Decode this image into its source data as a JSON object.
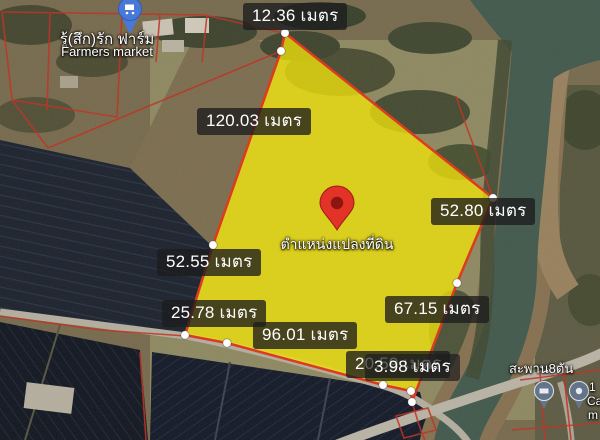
{
  "map": {
    "type": "satellite-parcel-view",
    "unit": "เมตร",
    "parcel": {
      "marker_label_thai": "ตำแหน่งแปลงที่ดิน",
      "marker_color": "#e33227",
      "fill_color": "#ecdf0e",
      "border_color": "#dd3b20",
      "measurements": [
        {
          "side": "top",
          "text": "12.36 เมตร",
          "value_m": 12.36
        },
        {
          "side": "upper-left",
          "text": "120.03 เมตร",
          "value_m": 120.03
        },
        {
          "side": "right",
          "text": "52.80 เมตร",
          "value_m": 52.8
        },
        {
          "side": "left",
          "text": "52.55 เมตร",
          "value_m": 52.55
        },
        {
          "side": "lower-left",
          "text": "25.78 เมตร",
          "value_m": 25.78
        },
        {
          "side": "bottom",
          "text": "96.01 เมตร",
          "value_m": 96.01
        },
        {
          "side": "lower-right",
          "text": "67.15 เมตร",
          "value_m": 67.15
        },
        {
          "side": "bottom-corner-a",
          "text": "20.59 เมตร",
          "value_m": 20.59
        },
        {
          "side": "bottom-corner-b",
          "text": "3.98 เมตร",
          "value_m": 3.98
        }
      ]
    },
    "poi": {
      "farmers_market": {
        "name_thai": "รู้(สึก)รัก ฟาร์ม",
        "name_en": "Farmers market",
        "icon": "shopping-cart-pin-icon",
        "pin_color": "#4878d8"
      },
      "bridge_label_thai": "สะพาน8ตัน",
      "edge_poi_fragments": {
        "line1": "1",
        "line2": "Ca",
        "line3": "m"
      }
    },
    "colors": {
      "label_background": "rgba(28,28,30,0.78)",
      "label_text": "#ffffff",
      "boundary_lines": "#bf3527",
      "river": "#41584b"
    }
  }
}
